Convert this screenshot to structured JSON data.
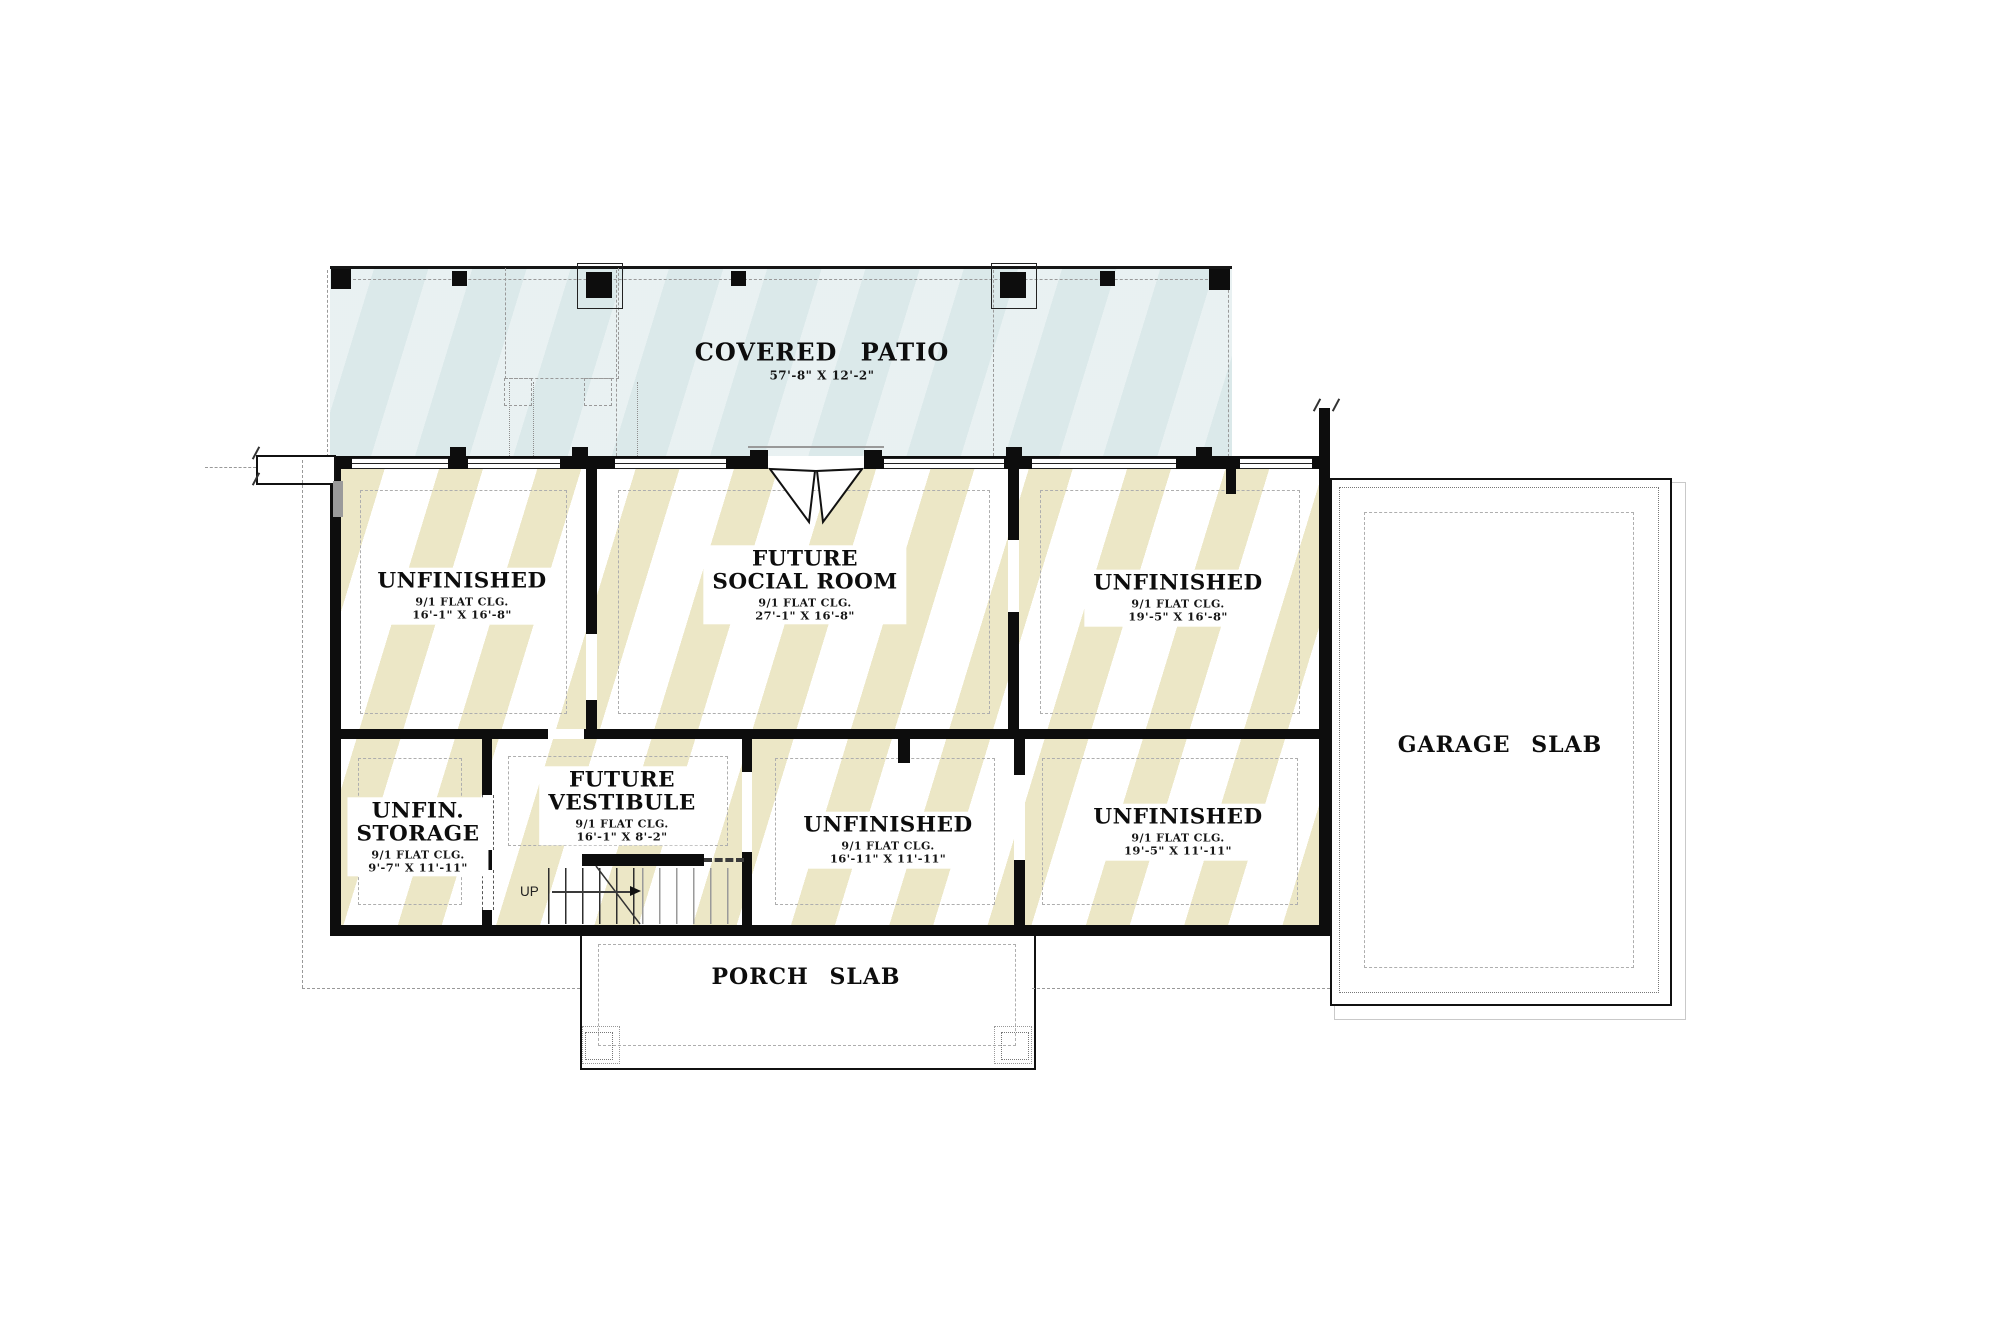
{
  "patio": {
    "label": "COVERED PATIO",
    "dims": "57'-8\" X 12'-2\""
  },
  "rooms": [
    {
      "line1": "UNFINISHED",
      "clg": "9/1 FLAT CLG.",
      "dims": "16'-1\" X 16'-8\""
    },
    {
      "line1": "FUTURE",
      "line2": "SOCIAL ROOM",
      "clg": "9/1 FLAT CLG.",
      "dims": "27'-1\" X 16'-8\""
    },
    {
      "line1": "UNFINISHED",
      "clg": "9/1 FLAT CLG.",
      "dims": "19'-5\" X 16'-8\""
    },
    {
      "line1": "UNFIN.",
      "line2": "STORAGE",
      "clg": "9/1 FLAT CLG.",
      "dims": "9'-7\" X 11'-11\""
    },
    {
      "line1": "FUTURE",
      "line2": "VESTIBULE",
      "clg": "9/1 FLAT CLG.",
      "dims": "16'-1\" X 8'-2\""
    },
    {
      "line1": "UNFINISHED",
      "clg": "9/1 FLAT CLG.",
      "dims": "16'-11\" X 11'-11\""
    },
    {
      "line1": "UNFINISHED",
      "clg": "9/1 FLAT CLG.",
      "dims": "19'-5\" X 11'-11\""
    }
  ],
  "slabs": {
    "garage": "GARAGE SLAB",
    "porch": "PORCH SLAB"
  },
  "stairs": {
    "up": "UP"
  },
  "colors": {
    "patio": "#dbe9ea",
    "hatch": "#ece7c6",
    "wall": "#0d0d0d",
    "dash": "#999999"
  }
}
